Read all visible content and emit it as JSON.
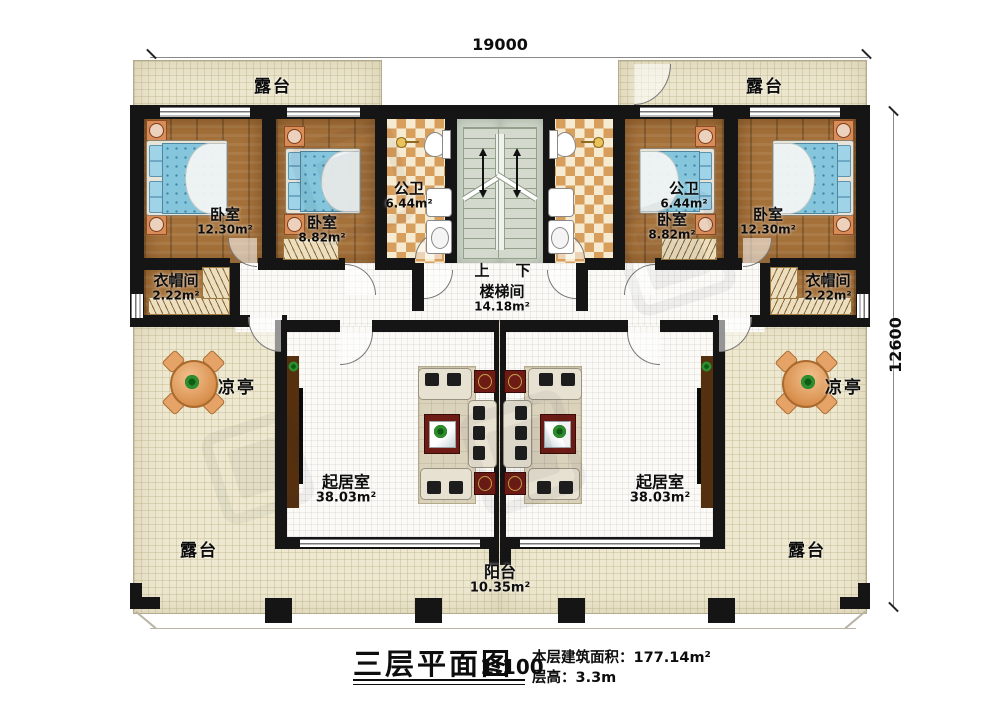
{
  "dimensions": {
    "width_label": "19000",
    "depth_label": "12600"
  },
  "stairwell": {
    "up": "上",
    "down": "下",
    "name": "楼梯间",
    "area": "14.18m²"
  },
  "rooms": {
    "terrace_top_left": {
      "name": "露台"
    },
    "terrace_top_right": {
      "name": "露台"
    },
    "terrace_bottom_left": {
      "name": "露台"
    },
    "terrace_bottom_right": {
      "name": "露台"
    },
    "bedroom_left_outer": {
      "name": "卧室",
      "area": "12.30m²"
    },
    "bedroom_left_inner": {
      "name": "卧室",
      "area": "8.82m²"
    },
    "bedroom_right_inner": {
      "name": "卧室",
      "area": "8.82m²"
    },
    "bedroom_right_outer": {
      "name": "卧室",
      "area": "12.30m²"
    },
    "bath_left": {
      "name": "公卫",
      "area": "6.44m²"
    },
    "bath_right": {
      "name": "公卫",
      "area": "6.44m²"
    },
    "cloak_left": {
      "name": "衣帽间",
      "area": "2.22m²"
    },
    "cloak_right": {
      "name": "衣帽间",
      "area": "2.22m²"
    },
    "living_left": {
      "name": "起居室",
      "area": "38.03m²"
    },
    "living_right": {
      "name": "起居室",
      "area": "38.03m²"
    },
    "pavilion_left": {
      "name": "凉亭"
    },
    "pavilion_right": {
      "name": "凉亭"
    },
    "balcony": {
      "name": "阳台",
      "area": "10.35m²"
    }
  },
  "title": {
    "main": "三层平面图",
    "scale": "1:100",
    "floor_area": "本层建筑面积：177.14m²",
    "floor_height": "层高：3.3m"
  },
  "colors": {
    "wall": "#151515",
    "wood_floor": "#a5713a",
    "tile_orange": "#d89e5c",
    "terrace": "#eee8d0",
    "bed_blue": "#85c6dc",
    "stair_green": "#cdd4c8",
    "accent_red_table": "#6d1b14"
  }
}
